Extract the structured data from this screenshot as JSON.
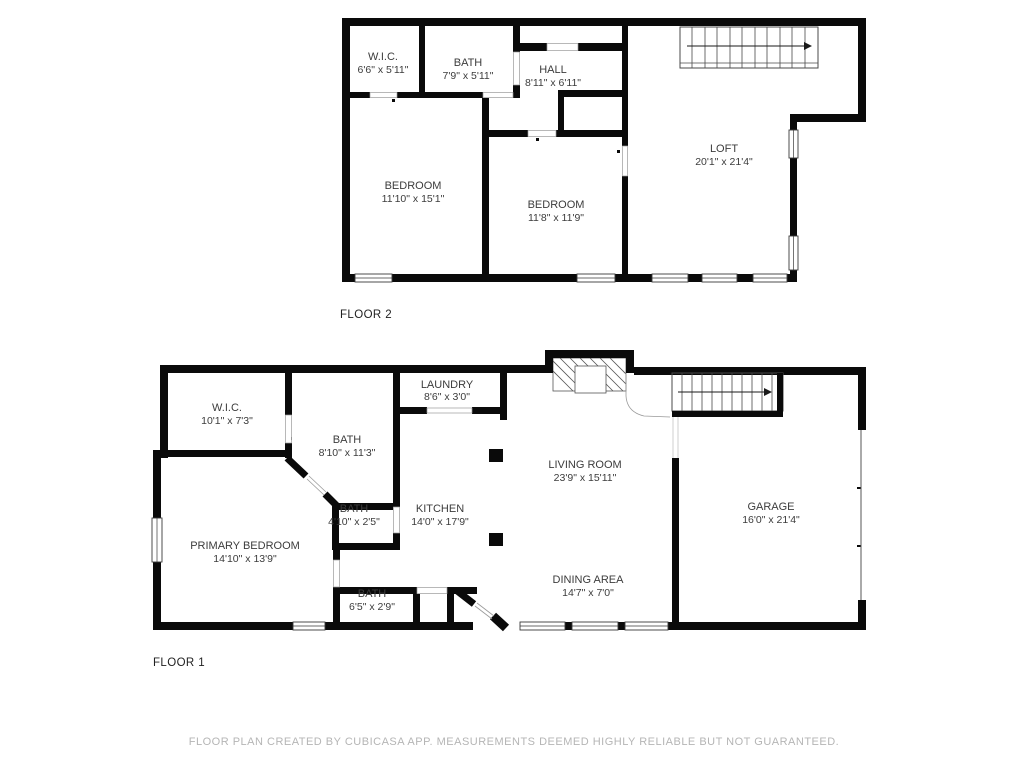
{
  "floors": [
    {
      "label": "FLOOR 2",
      "rooms": [
        {
          "name": "W.I.C.",
          "dims": "6'6\" x 5'11\""
        },
        {
          "name": "BATH",
          "dims": "7'9\" x 5'11\""
        },
        {
          "name": "HALL",
          "dims": "8'11\" x 6'11\""
        },
        {
          "name": "BEDROOM",
          "dims": "11'10\" x 15'1\""
        },
        {
          "name": "BEDROOM",
          "dims": "11'8\" x 11'9\""
        },
        {
          "name": "LOFT",
          "dims": "20'1\" x 21'4\""
        }
      ]
    },
    {
      "label": "FLOOR 1",
      "rooms": [
        {
          "name": "W.I.C.",
          "dims": "10'1\" x 7'3\""
        },
        {
          "name": "LAUNDRY",
          "dims": "8'6\" x 3'0\""
        },
        {
          "name": "BATH",
          "dims": "8'10\" x 11'3\""
        },
        {
          "name": "BATH",
          "dims": "4'10\" x 2'5\""
        },
        {
          "name": "KITCHEN",
          "dims": "14'0\" x 17'9\""
        },
        {
          "name": "LIVING ROOM",
          "dims": "23'9\" x 15'11\""
        },
        {
          "name": "PRIMARY BEDROOM",
          "dims": "14'10\" x 13'9\""
        },
        {
          "name": "BATH",
          "dims": "6'5\" x 2'9\""
        },
        {
          "name": "DINING AREA",
          "dims": "14'7\" x 7'0\""
        },
        {
          "name": "GARAGE",
          "dims": "16'0\" x 21'4\""
        }
      ]
    }
  ],
  "footer": "FLOOR PLAN CREATED BY CUBICASA APP. MEASUREMENTS DEEMED HIGHLY RELIABLE BUT NOT GUARANTEED.",
  "colors": {
    "wall": "#0a0a0a",
    "label": "#3c3c3c",
    "footer": "#b5b5b5",
    "background": "#ffffff"
  }
}
